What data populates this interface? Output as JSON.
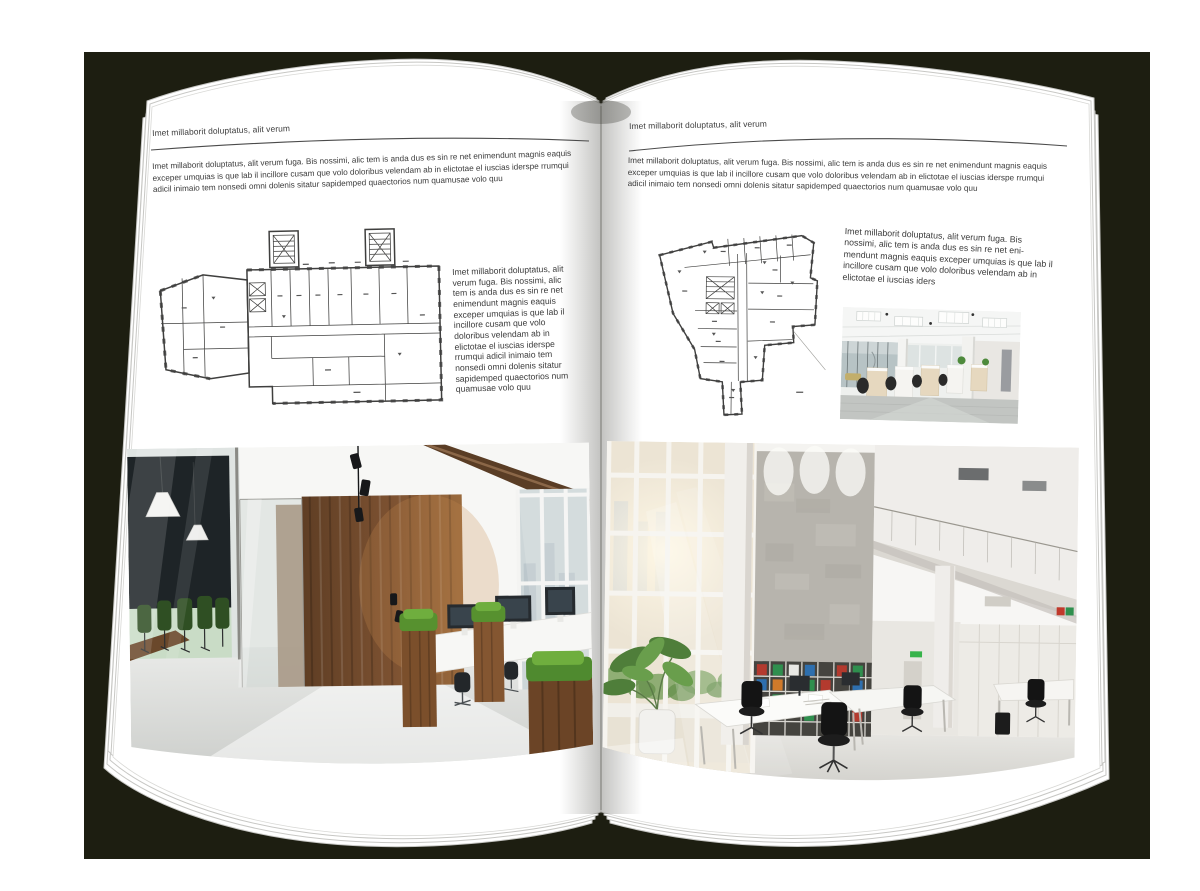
{
  "book": {
    "left_page": {
      "header": "Imet millaborit doluptatus, alit verum",
      "intro": "Imet millaborit doluptatus, alit verum fuga. Bis nossimi, alic tem is anda dus es sin re net enimendunt magnis eaquis exceper umquias is que lab il incillore cusam que volo doloribus velendam ab in elictotae el iuscias iderspe rrumqui adicil inimaio tem nonsedi omni dolenis sitatur sapidemped quaectorios num quamusae volo quu",
      "caption": "Imet millaborit doluptatus, alit verum fuga. Bis nossimi, alic tem is anda dus es sin re net enimendunt magnis eaquis exceper umquias is que lab il incillore cusam que volo doloribus velendam ab in elictotae el iuscias iderspe rrumqui adicil inimaio tem nonsedi omni dolenis sitatur sapidemped quaectorios num quamusae volo quu"
    },
    "right_page": {
      "header": "Imet millaborit doluptatus, alit verum",
      "intro": "Imet millaborit doluptatus, alit verum fuga. Bis nossimi, alic tem is anda dus es sin re net enimendunt magnis eaquis exceper umquias is que lab il incillore cusam que volo doloribus velendam ab in elictotae el iuscias iderspe rrumqui adicil inimaio tem nonsedi omni dolenis sitatur sapidemped quaectorios num quamusae volo quu",
      "caption": "Imet millaborit doluptatus, alit verum fuga. Bis nossimi, alic tem is anda dus es sin re net eni-mendunt magnis eaquis exceper umquias is que lab il incillore cusam que volo doloribus velendam ab in elictotae el iuscias iders"
    }
  },
  "colors": {
    "backdrop": "#1d1e11",
    "page": "#ffffff",
    "ink": "#3b3b3b",
    "plan_ink": "#3f3f3e",
    "wood": "#7c5131",
    "grass": "#5f9a33",
    "binder_red": "#b33a2e",
    "binder_green": "#2f8f4e",
    "binder_blue": "#2e6fae"
  }
}
